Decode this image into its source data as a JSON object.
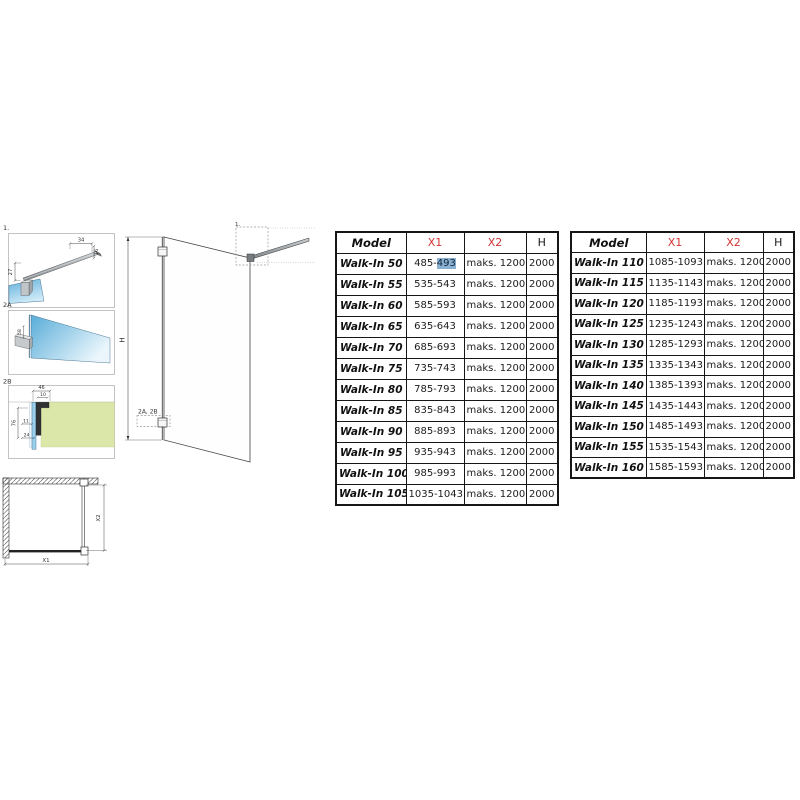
{
  "palette": {
    "accent_red": "#cf3434",
    "selection_blue": "#8ab1d2",
    "glass_blue": "#7fc0e4",
    "wall_green": "#dbe7a9"
  },
  "drawings": {
    "d1": {
      "label": "1.",
      "dim_34": "34",
      "dim_16": "16",
      "dim_27": "27"
    },
    "d2a": {
      "label": "2A",
      "dim_58": "58"
    },
    "d2b": {
      "label": "2B",
      "dim_46": "46",
      "dim_10": "10",
      "dim_76": "76",
      "dim_11": "11",
      "dim_24": "24"
    },
    "main": {
      "h_label": "H",
      "callout_label": "2A, 2B",
      "top_callout_label": "1."
    },
    "plan": {
      "x1_label": "X1",
      "x2_label": "X2"
    }
  },
  "table_left": {
    "headers": [
      "Model",
      "X1",
      "X2",
      "H"
    ],
    "rows": [
      {
        "model": "Walk-In 50",
        "x1": "485-493",
        "x1_prefix": "485-",
        "x1_selected": "493",
        "x2": "maks. 1200",
        "h": "2000"
      },
      {
        "model": "Walk-In 55",
        "x1": "535-543",
        "x2": "maks. 1200",
        "h": "2000"
      },
      {
        "model": "Walk-In 60",
        "x1": "585-593",
        "x2": "maks. 1200",
        "h": "2000"
      },
      {
        "model": "Walk-In 65",
        "x1": "635-643",
        "x2": "maks. 1200",
        "h": "2000"
      },
      {
        "model": "Walk-In 70",
        "x1": "685-693",
        "x2": "maks. 1200",
        "h": "2000"
      },
      {
        "model": "Walk-In 75",
        "x1": "735-743",
        "x2": "maks. 1200",
        "h": "2000"
      },
      {
        "model": "Walk-In 80",
        "x1": "785-793",
        "x2": "maks. 1200",
        "h": "2000"
      },
      {
        "model": "Walk-In 85",
        "x1": "835-843",
        "x2": "maks. 1200",
        "h": "2000"
      },
      {
        "model": "Walk-In 90",
        "x1": "885-893",
        "x2": "maks. 1200",
        "h": "2000"
      },
      {
        "model": "Walk-In 95",
        "x1": "935-943",
        "x2": "maks. 1200",
        "h": "2000"
      },
      {
        "model": "Walk-In 100",
        "x1": "985-993",
        "x2": "maks. 1200",
        "h": "2000"
      },
      {
        "model": "Walk-In 105",
        "x1": "1035-1043",
        "x2": "maks. 1200",
        "h": "2000"
      }
    ]
  },
  "table_right": {
    "headers": [
      "Model",
      "X1",
      "X2",
      "H"
    ],
    "rows": [
      {
        "model": "Walk-In 110",
        "x1": "1085-1093",
        "x2": "maks. 1200",
        "h": "2000"
      },
      {
        "model": "Walk-In 115",
        "x1": "1135-1143",
        "x2": "maks. 1200",
        "h": "2000"
      },
      {
        "model": "Walk-In 120",
        "x1": "1185-1193",
        "x2": "maks. 1200",
        "h": "2000"
      },
      {
        "model": "Walk-In 125",
        "x1": "1235-1243",
        "x2": "maks. 1200",
        "h": "2000"
      },
      {
        "model": "Walk-In 130",
        "x1": "1285-1293",
        "x2": "maks. 1200",
        "h": "2000"
      },
      {
        "model": "Walk-In 135",
        "x1": "1335-1343",
        "x2": "maks. 1200",
        "h": "2000"
      },
      {
        "model": "Walk-In 140",
        "x1": "1385-1393",
        "x2": "maks. 1200",
        "h": "2000"
      },
      {
        "model": "Walk-In 145",
        "x1": "1435-1443",
        "x2": "maks. 1200",
        "h": "2000"
      },
      {
        "model": "Walk-In 150",
        "x1": "1485-1493",
        "x2": "maks. 1200",
        "h": "2000"
      },
      {
        "model": "Walk-In 155",
        "x1": "1535-1543",
        "x2": "maks. 1200",
        "h": "2000"
      },
      {
        "model": "Walk-In 160",
        "x1": "1585-1593",
        "x2": "maks. 1200",
        "h": "2000"
      }
    ]
  }
}
